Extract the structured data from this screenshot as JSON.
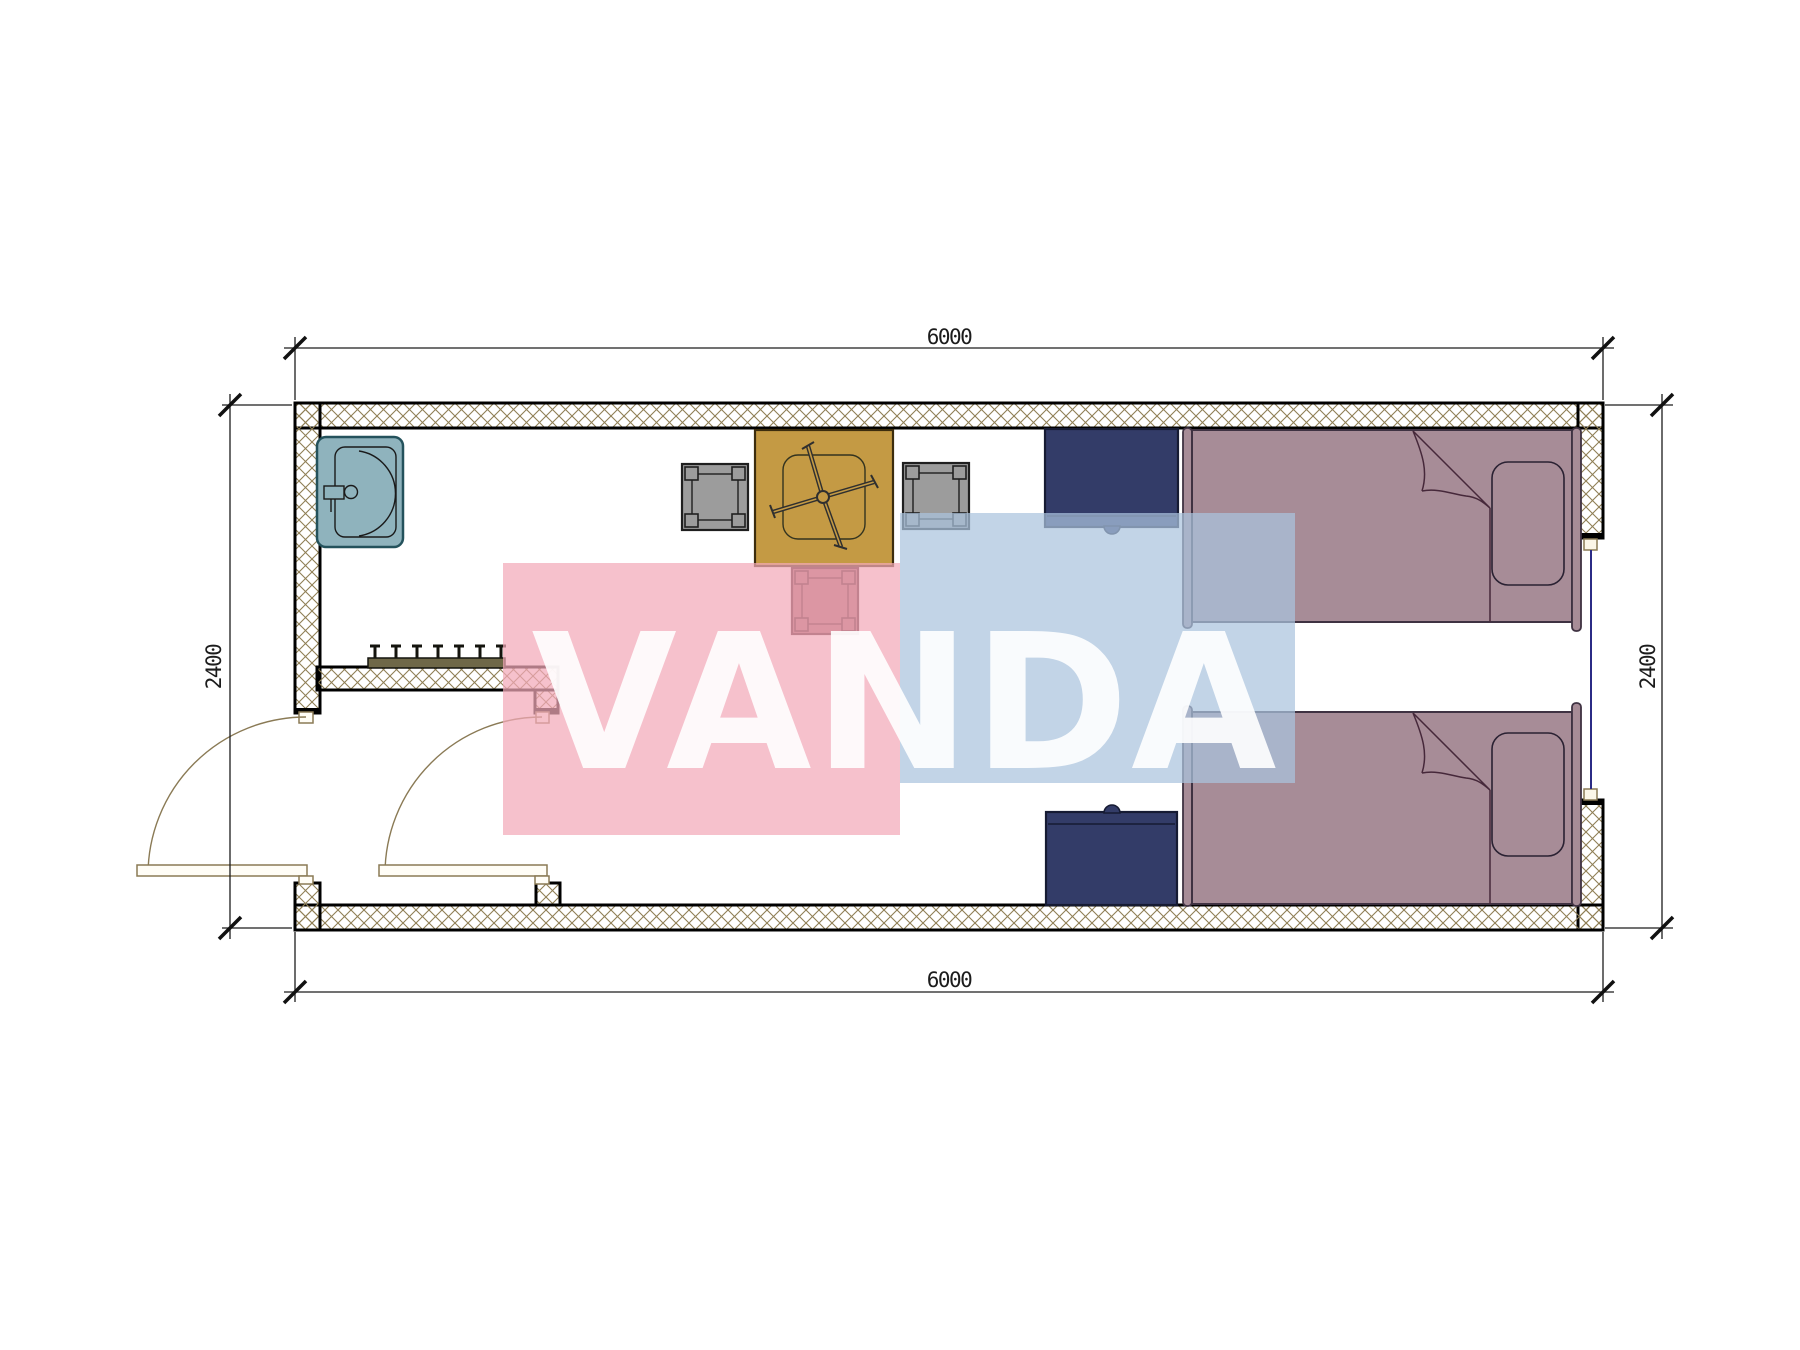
{
  "plan": {
    "dimensions": {
      "top": "6000",
      "bottom": "6000",
      "left": "2400",
      "right": "2400"
    },
    "watermark": {
      "text": "VANDA",
      "pink_color": "#f3a9b8",
      "blue_color": "#abc4de",
      "text_color": "#ffffff"
    },
    "colors": {
      "wall_hatch": "#8f7f55",
      "wall_line": "#000000",
      "sink": "#8fb3bd",
      "table": "#c49a44",
      "chair_gray": "#9c9c9c",
      "chair_red": "#a3646c",
      "nightstand": "#333c68",
      "bed": "#a78c97",
      "door": "#8a7a55",
      "window": "#2b2b85",
      "coat_rack": "#6f6848",
      "dimension_text": "#1c1c1c"
    }
  }
}
